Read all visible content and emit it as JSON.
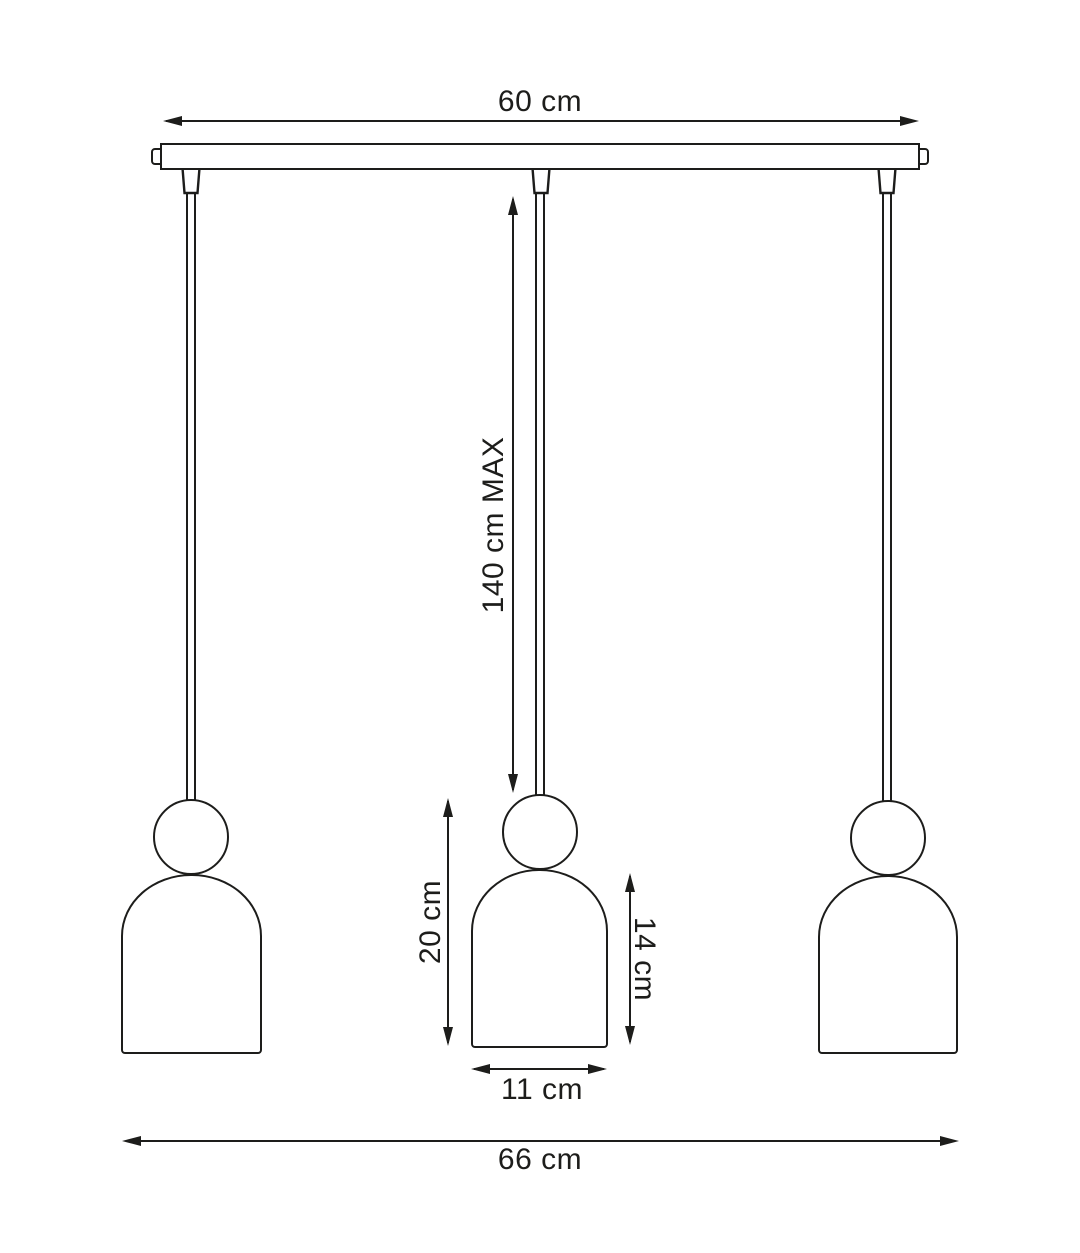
{
  "colors": {
    "line": "#1d1d1b",
    "background": "#ffffff"
  },
  "dimensions": {
    "bar_width": {
      "label": "60 cm"
    },
    "max_drop": {
      "label": "140 cm MAX"
    },
    "lamp_height": {
      "label": "20 cm"
    },
    "shade_height": {
      "label": "14 cm"
    },
    "shade_width": {
      "label": "11 cm"
    },
    "total_width": {
      "label": "66 cm"
    }
  }
}
